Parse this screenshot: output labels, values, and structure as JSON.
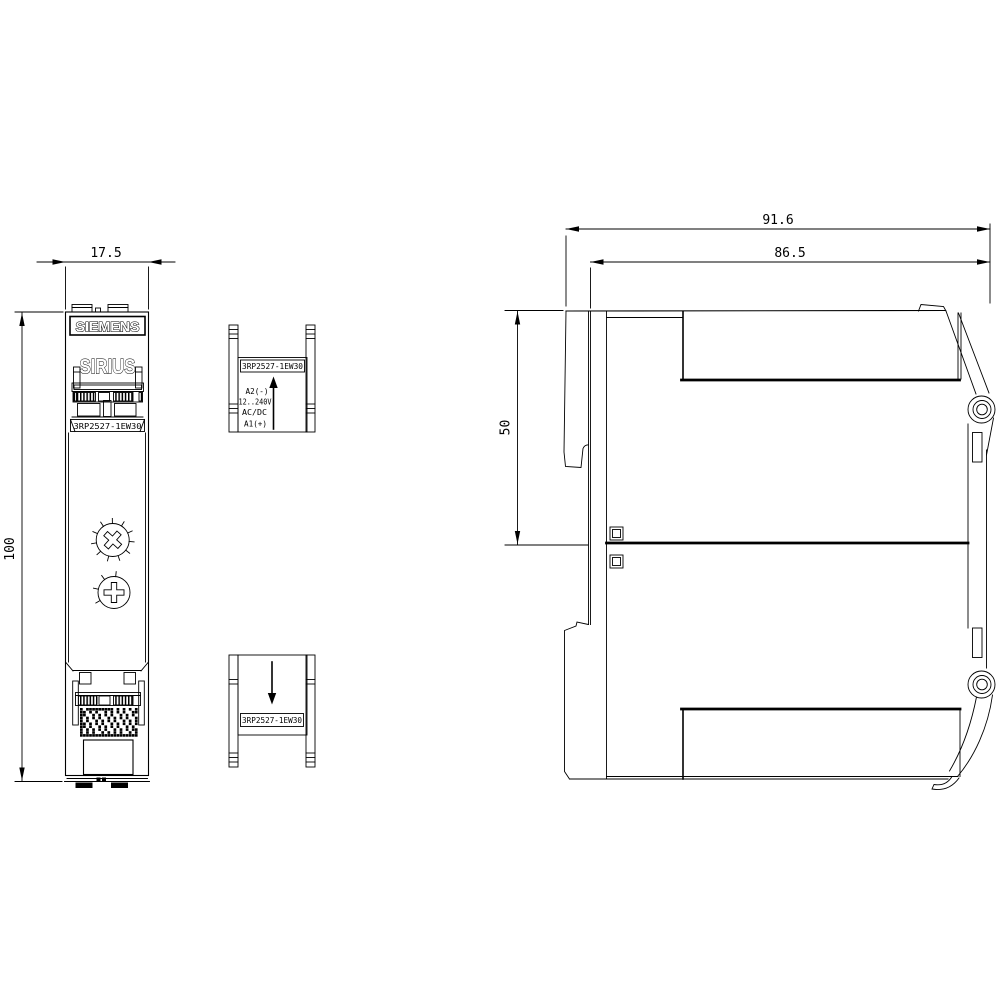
{
  "colors": {
    "line": "#000000",
    "background": "#ffffff"
  },
  "front_view": {
    "brand_logo": "SIEMENS",
    "product_line": "SIRIUS",
    "part_number": "3RP2527-1EW30",
    "width_dim": "17.5",
    "height_dim": "100"
  },
  "terminal_detail_top": {
    "part_number": "3RP2527-1EW30",
    "terminal_top": "A2(-)",
    "voltage_range": "12..240V",
    "supply_type": "AC/DC",
    "terminal_bottom": "A1(+)"
  },
  "terminal_detail_bottom": {
    "part_number": "3RP2527-1EW30"
  },
  "side_view": {
    "total_depth_dim": "91.6",
    "body_depth_dim": "86.5",
    "upper_height_dim": "50"
  }
}
